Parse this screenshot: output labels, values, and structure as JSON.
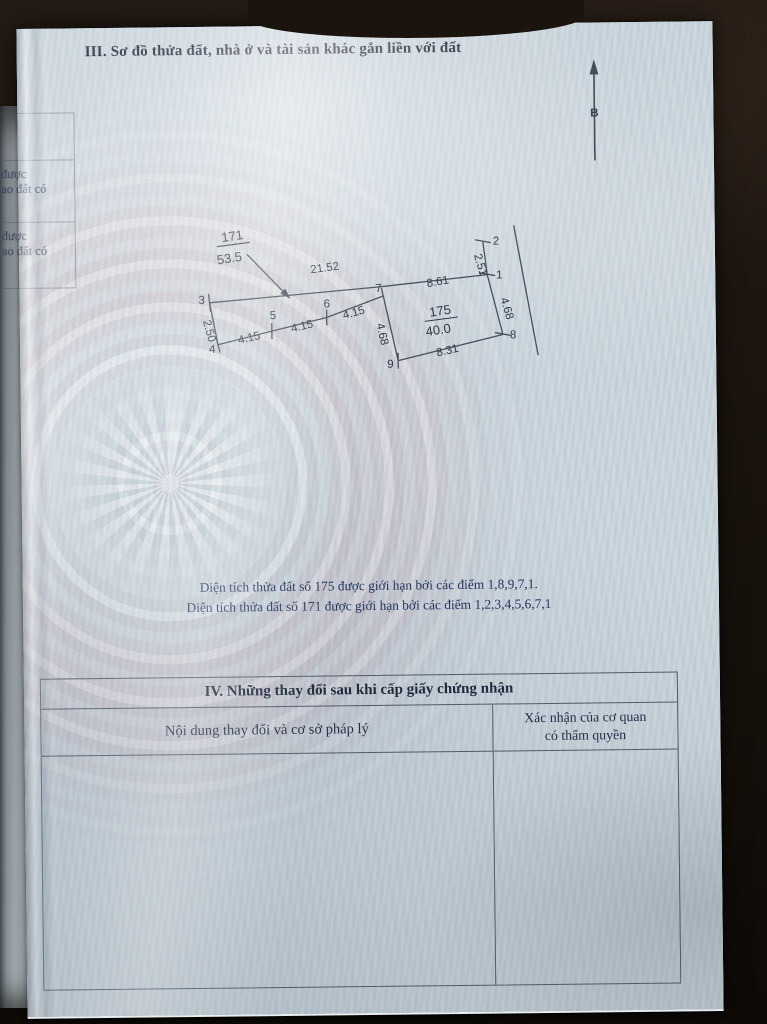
{
  "document": {
    "section3_title": "III. Sơ đồ thửa đất, nhà ở và tài sản khác gắn liền với đất",
    "compass_north": "B",
    "notes": {
      "line1": "Diện tích thửa đất số 175 được giới hạn bởi các điểm 1,8,9,7,1.",
      "line2": "Diện tích thửa đất số 171 được giới hạn bởi các điểm 1,2,3,4,5,6,7,1"
    },
    "section4": {
      "title": "IV. Những thay đổi sau khi cấp giấy chứng nhận",
      "col_content_header": "Nội dung thay đổi và cơ sở pháp lý",
      "col_confirm_header_line1": "Xác nhận của cơ quan",
      "col_confirm_header_line2": "có thẩm quyền"
    }
  },
  "diagram": {
    "parcel_171": {
      "number": "171",
      "area": "53.5"
    },
    "parcel_175": {
      "number": "175",
      "area": "40.0"
    },
    "vertices": {
      "v1": "1",
      "v2": "2",
      "v3": "3",
      "v4": "4",
      "v5": "5",
      "v6": "6",
      "v7": "7",
      "v8": "8",
      "v9": "9"
    },
    "edges": {
      "top": "21.52",
      "top_right": "8.61",
      "left": "2.50",
      "bottom_a": "4.15",
      "bottom_b": "4.15",
      "bottom_c": "4.15",
      "right_upper": "2.51",
      "right_lower": "4.68",
      "mid_vertical": "4.68",
      "bottom_right": "8.31"
    }
  },
  "underlay_page": {
    "row1": {
      "line1": "được",
      "line2": "ao đất có"
    },
    "row2": {
      "line1": "được",
      "line2": "ao đất có"
    }
  }
}
